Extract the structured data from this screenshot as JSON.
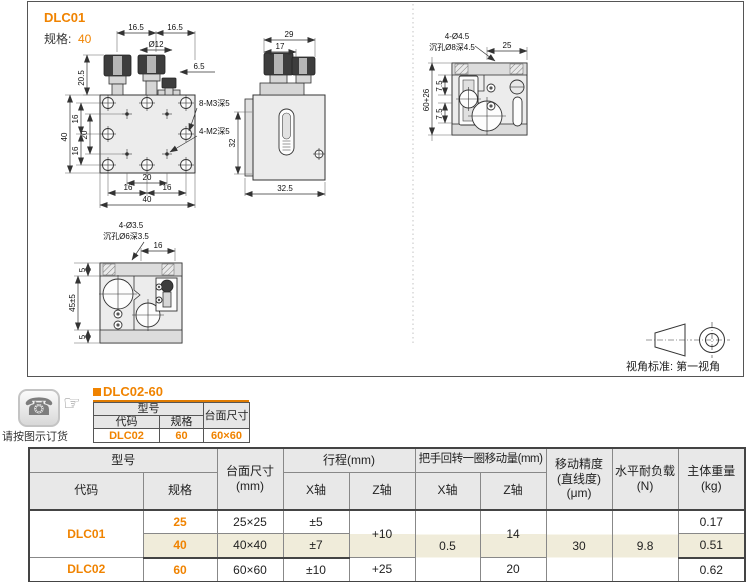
{
  "colors": {
    "accent": "#f08300",
    "highlight_row": "#f0ecda",
    "header_bg": "#e8e8e8",
    "title_underline": "#e07b00"
  },
  "drawing": {
    "title": "DLC01",
    "spec_label": "规格:",
    "spec_value": "40",
    "projection_label": "视角标准: 第一视角",
    "front_view": {
      "dim_top_left": "16.5",
      "dim_top_right": "16.5",
      "dim_dia": "Ø12",
      "dim_knob_h": "20.5",
      "dim_right": "6.5",
      "dim_left_total": "40",
      "dim_left_16a": "16",
      "dim_left_20": "20",
      "dim_left_16b": "16",
      "dim_bot_20": "20",
      "dim_bot_16a": "16",
      "dim_bot_16b": "16",
      "dim_bot_total": "40",
      "callout_m3": "8-M3深5",
      "callout_m2": "4-M2深5"
    },
    "side_view": {
      "dim_top_29": "29",
      "dim_top_17": "17",
      "dim_left_32": "32",
      "dim_bot": "32.5"
    },
    "top_view": {
      "callout_1": "4-Ø4.5",
      "callout_2": "沉孔Ø8深4.5",
      "dim_top_25": "25",
      "dim_left_total": "60+26",
      "dim_75a": "7.5",
      "dim_75b": "7.5"
    },
    "bottom_view": {
      "callout_1": "4-Ø3.5",
      "callout_2": "沉孔Ø6深3.5",
      "dim_top_16": "16",
      "dim_5a": "5",
      "dim_45": "45±5",
      "dim_5b": "5"
    }
  },
  "order": {
    "note": "请按图示订货",
    "hand": "☞",
    "phone": "☎",
    "title": "DLC02-60",
    "table": {
      "h_model": "型号",
      "h_size": "台面尺寸",
      "h_code": "代码",
      "h_spec": "规格",
      "code": "DLC02",
      "spec": "60",
      "size": "60×60"
    }
  },
  "spec_table": {
    "h_model": "型号",
    "h_code": "代码",
    "h_spec": "规格",
    "h_size": "台面尺寸\n(mm)",
    "h_travel": "行程(mm)",
    "h_x": "X轴",
    "h_z": "Z轴",
    "h_handle": "把手回转一圈移动量(mm)",
    "h_hx": "X轴",
    "h_hz": "Z轴",
    "h_precision": "移动精度\n(直线度)\n(μm)",
    "h_load": "水平耐负载\n(N)",
    "h_weight": "主体重量\n(kg)",
    "merged": {
      "travel_z_12": "+10",
      "handle_x": "0.5",
      "handle_z_12": "14",
      "precision": "30",
      "load": "9.8"
    },
    "rows": [
      {
        "code": "DLC01",
        "spec": "25",
        "size": "25×25",
        "travel_x": "±5",
        "weight": "0.17"
      },
      {
        "spec": "40",
        "size": "40×40",
        "travel_x": "±7",
        "weight": "0.51"
      },
      {
        "code": "DLC02",
        "spec": "60",
        "size": "60×60",
        "travel_x": "±10",
        "travel_z": "+25",
        "handle_z": "20",
        "weight": "0.62"
      }
    ]
  }
}
